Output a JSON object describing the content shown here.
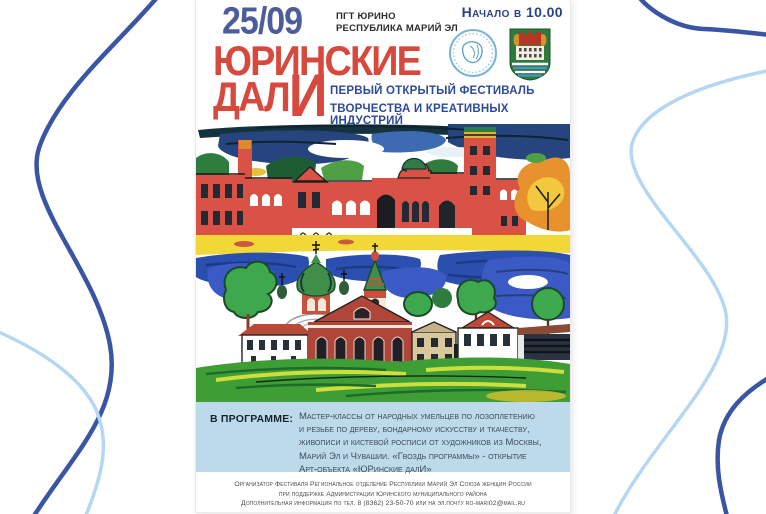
{
  "poster": {
    "header": {
      "date": "25/09",
      "location_line1": "ПГТ ЮРИНО",
      "location_line2": "РЕСПУБЛИКА МАРИЙ ЭЛ",
      "start_time": "Начало в 10.00"
    },
    "emblems": {
      "round_emblem": "union-round-emblem",
      "coat_of_arms": "yurino-coat-of-arms"
    },
    "title": {
      "line1": "ЮРИНСКИЕ",
      "line2_prefix": "ДАЛ",
      "line2_emphasis": "И",
      "subtitle_line1": "ПЕРВЫЙ ОТКРЫТЫЙ ФЕСТИВАЛЬ",
      "subtitle_line2": "ТВОРЧЕСТВА И КРЕАТИВНЫХ ИНДУСТРИЙ"
    },
    "illustration_caption": "naive-art painting of Sheremetev castle, river and Yurino village with church",
    "program": {
      "label": "В ПРОГРАММЕ:",
      "text_lines": [
        "Мастер-классы от народных умельцев  по лозоплетению",
        "и резьбе по дереву, бондарному искусству и ткачеству,",
        "живописи и кистевой росписи  от художников из Москвы,",
        "Марий Эл и Чувашии. «Гвоздь программы» - открытие",
        "Арт-объекта «ЮРинские далИ»"
      ]
    },
    "footer": {
      "line1": "Организатор Фестиваля  Региональное отделение Республики Марий Эл Союза женщин России",
      "line2": "при поддержке Администрации Юринского муниципального района",
      "line3": "Дополнительная информация по тел. 8 (8362) 23-50-70 или на эл.почту ro-mari02@mail.ru"
    },
    "colors": {
      "title_red": "#d8493d",
      "accent_blue": "#2c4287",
      "date_blue": "#4d5c9b",
      "program_bg": "#bcdaea",
      "curve_dark": "#3a55a4",
      "curve_light": "#b5d7f2"
    }
  }
}
